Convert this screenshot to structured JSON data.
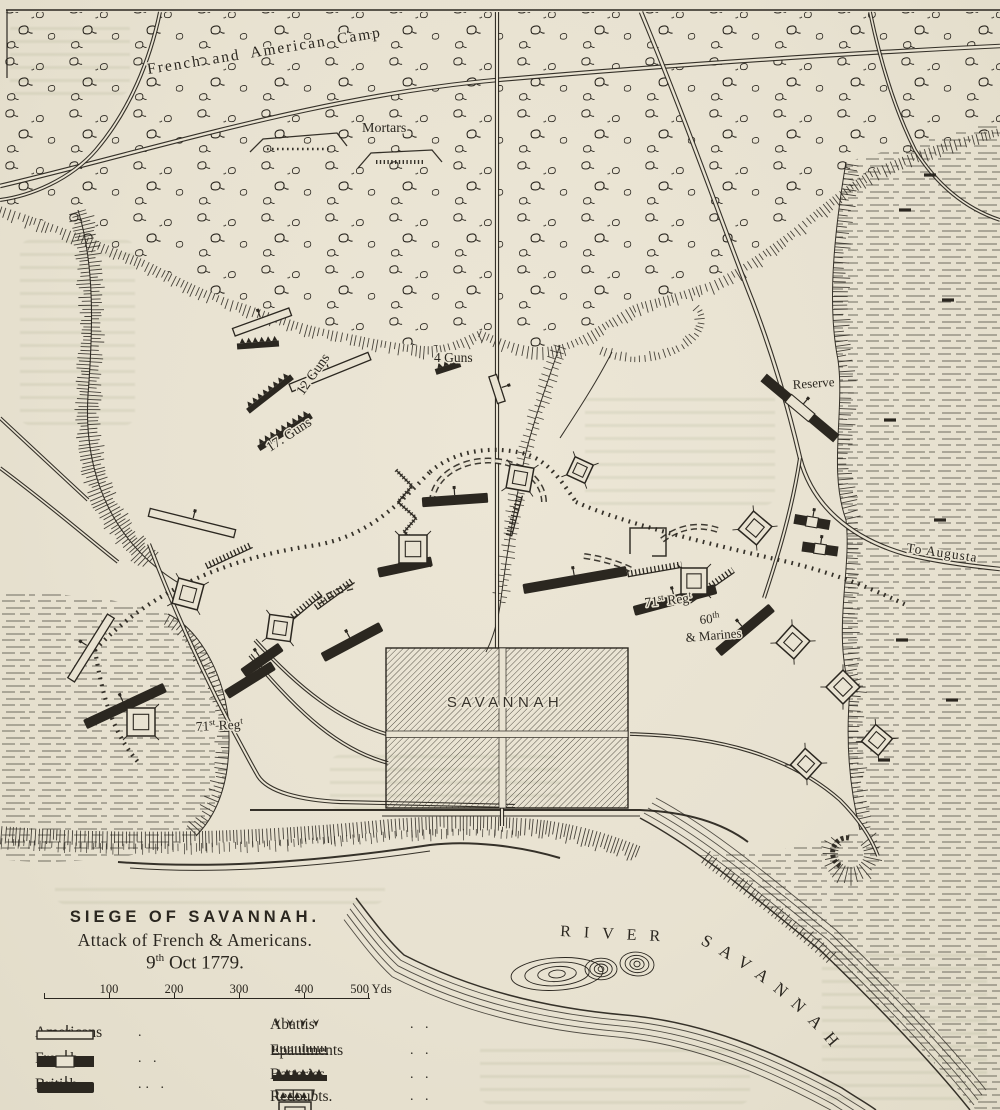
{
  "title_block": {
    "title": "SIEGE OF SAVANNAH.",
    "subtitle": "Attack of French & Americans.",
    "date_num": "9",
    "date_sup": "th",
    "date_rest": " Oct 1779."
  },
  "scale_bar": {
    "unit_labels": [
      "100",
      "200",
      "300",
      "400",
      "500 Yds"
    ]
  },
  "legend": {
    "forces": [
      {
        "label": "Americans",
        "dots": "."
      },
      {
        "label": "French.",
        "dots": ". ."
      },
      {
        "label": "British",
        "dots": ".. ."
      }
    ],
    "features": [
      {
        "label": "Abattis",
        "dots": ". ."
      },
      {
        "label": "Epaulments",
        "dots": ". ."
      },
      {
        "label": "Batteries",
        "dots": ". ."
      },
      {
        "label": "Redoubts.",
        "dots": ". ."
      }
    ]
  },
  "map_labels": {
    "camp": "French and American Camp",
    "mortars": "Mortars",
    "guns_12": "12 Guns",
    "guns_17": "17. Guns",
    "guns_4": "4 Guns",
    "reserve": "Reserve",
    "to_augusta": "To Augusta",
    "city": "SAVANNAH",
    "river_word_1": "RIVER",
    "river_word_2": "SAVANNAH",
    "regt_71": {
      "num": "71",
      "sup": "st",
      "word": " Reg",
      "word_sup": "t"
    },
    "regt_60": {
      "num": "60",
      "sup": "th",
      "line2": "& Marines"
    }
  },
  "colors": {
    "paper": "#e9e3d2",
    "ink": "#2b2720",
    "ghost_text": "#9aa383",
    "city_hatch": "#4a463c"
  }
}
